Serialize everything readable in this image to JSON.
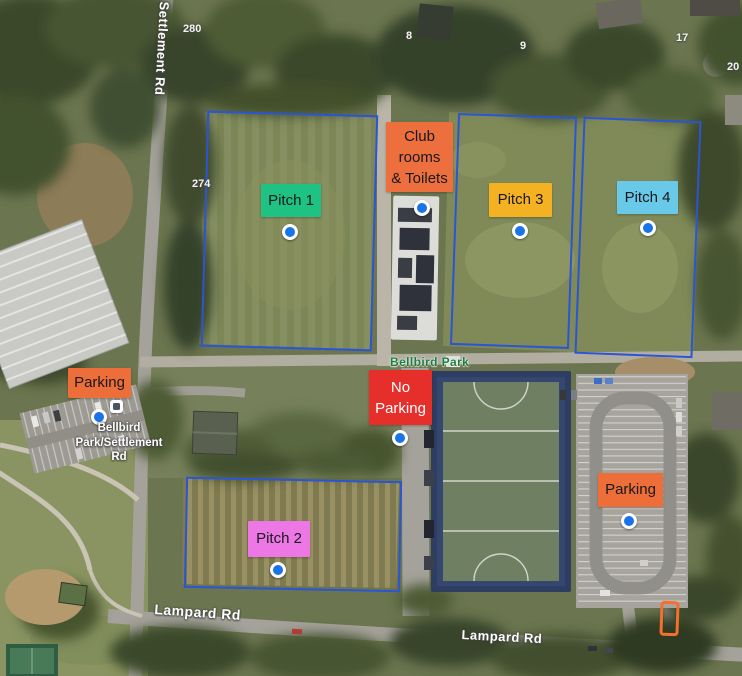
{
  "map": {
    "road_labels": {
      "settlement_rd": "Settlement Rd",
      "lampard_rd_west": "Lampard Rd",
      "lampard_rd_east": "Lampard Rd"
    },
    "park_label": "Bellbird Park",
    "bus_stop_label": {
      "line1": "Bellbird",
      "line2": "Park/Settlement",
      "line3": "Rd"
    },
    "house_numbers": {
      "h280": "280",
      "h274": "274",
      "h8": "8",
      "h9": "9",
      "h17": "17",
      "h20": "20"
    },
    "annotations": {
      "pitch_1": {
        "label": "Pitch 1",
        "color": "#1ec283"
      },
      "club_rooms": {
        "line1": "Club",
        "line2": "rooms",
        "line3": "& Toilets",
        "color": "#ec6f3d"
      },
      "pitch_3": {
        "label": "Pitch 3",
        "color": "#f4b223"
      },
      "pitch_4": {
        "label": "Pitch 4",
        "color": "#69c9e9"
      },
      "parking_west": {
        "label": "Parking",
        "color": "#ee6e3a"
      },
      "no_parking": {
        "line1": "No",
        "line2": "Parking",
        "color": "#e62e2b",
        "text_color": "#ffffff"
      },
      "pitch_2": {
        "label": "Pitch 2",
        "color": "#ec77e5"
      },
      "parking_east": {
        "label": "Parking",
        "color": "#ee6e3a"
      }
    },
    "colors": {
      "pin": "#1a73e8",
      "pitch_outline": "#2b55d4",
      "highlight_outline": "#f4702c",
      "park_text": "#1e7e3e"
    }
  }
}
